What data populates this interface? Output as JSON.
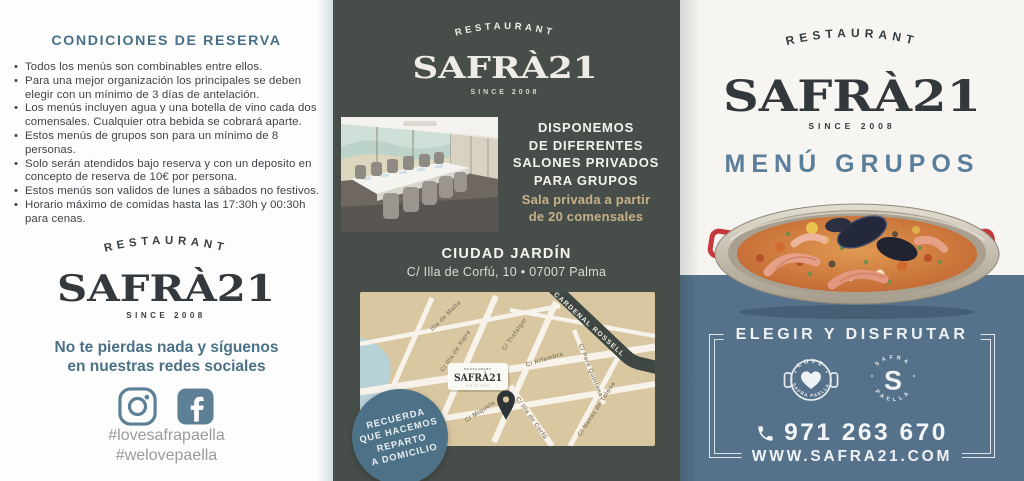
{
  "brand": {
    "restaurant": "RESTAURANT",
    "name": "SAFRÀ21",
    "since": "SINCE 2008"
  },
  "colors": {
    "accent_teal": "#46708a",
    "slate_blue": "#56728a",
    "badge_blue": "#4d7187",
    "dark_panel": "#474e49",
    "tan_text": "#c7b18a",
    "map_tan": "#d9c7a1",
    "logo_charcoal": "#363b3f",
    "icon_blue": "#5e8096",
    "hashtag_gray": "#9b9b9b",
    "handle_red": "#c5393c"
  },
  "left_panel": {
    "title": "CONDICIONES DE RESERVA",
    "bullets": [
      "Todos los menús son combinables entre ellos.",
      "Para una mejor organización los principales se deben elegir con un mínimo de 3 días de antelación.",
      "Los menús incluyen agua y una botella de vino cada dos comensales. Cualquier otra bebida se cobrará aparte.",
      "Estos menús de grupos son para un mínimo de 8 personas.",
      "Solo serán atendidos bajo reserva y con un deposito en concepto de reserva de 10€ por persona.",
      "Estos menús son validos de lunes a sábados no festivos.",
      "Horario máximo de comidas hasta las 17:30h y 00:30h para cenas."
    ],
    "social": {
      "line1": "No te pierdas nada y síguenos",
      "line2": "en nuestras redes sociales"
    },
    "hashtags": [
      "#lovesafrapaella",
      "#welovepaella"
    ]
  },
  "middle_panel": {
    "headline_lines": [
      "DISPONEMOS",
      "DE DIFERENTES",
      "SALONES PRIVADOS",
      "PARA GRUPOS"
    ],
    "sub_lines": [
      "Sala privada a partir",
      "de 20 comensales"
    ],
    "location": {
      "name": "CIUDAD JARDÍN",
      "address": "C/ Illa de Corfú, 10 • 07007 Palma"
    },
    "map": {
      "streets": {
        "malta": "Illa de Malta",
        "xipre": "C/ Illa de Xipre",
        "trafalgar": "C/ Trafalgar",
        "alfambra": "C/ Alfambra",
        "cardenal": "CARDENAL ROSSELL",
        "pere": "C/ Pere Quintana",
        "miquela": "C/ Miquela",
        "corfu": "C/ Illa de Corfú",
        "navas": "C/ Navas de Tolosa"
      }
    },
    "badge_lines": [
      "RECUERDA",
      "QUE HACEMOS",
      "REPARTO",
      "A DOMICILIO"
    ]
  },
  "right_panel": {
    "menu_title": "MENÚ GRUPOS",
    "frame_title": "ELEGIR Y DISFRUTAR",
    "stamps": {
      "love_top": "LOVE",
      "love_bottom": "SAFRA PAELLA",
      "s_letter": "S",
      "ring_top": "SAFRA",
      "ring_bottom": "PAELLA"
    },
    "phone": "971 263 670",
    "website": "WWW.SAFRA21.COM"
  }
}
